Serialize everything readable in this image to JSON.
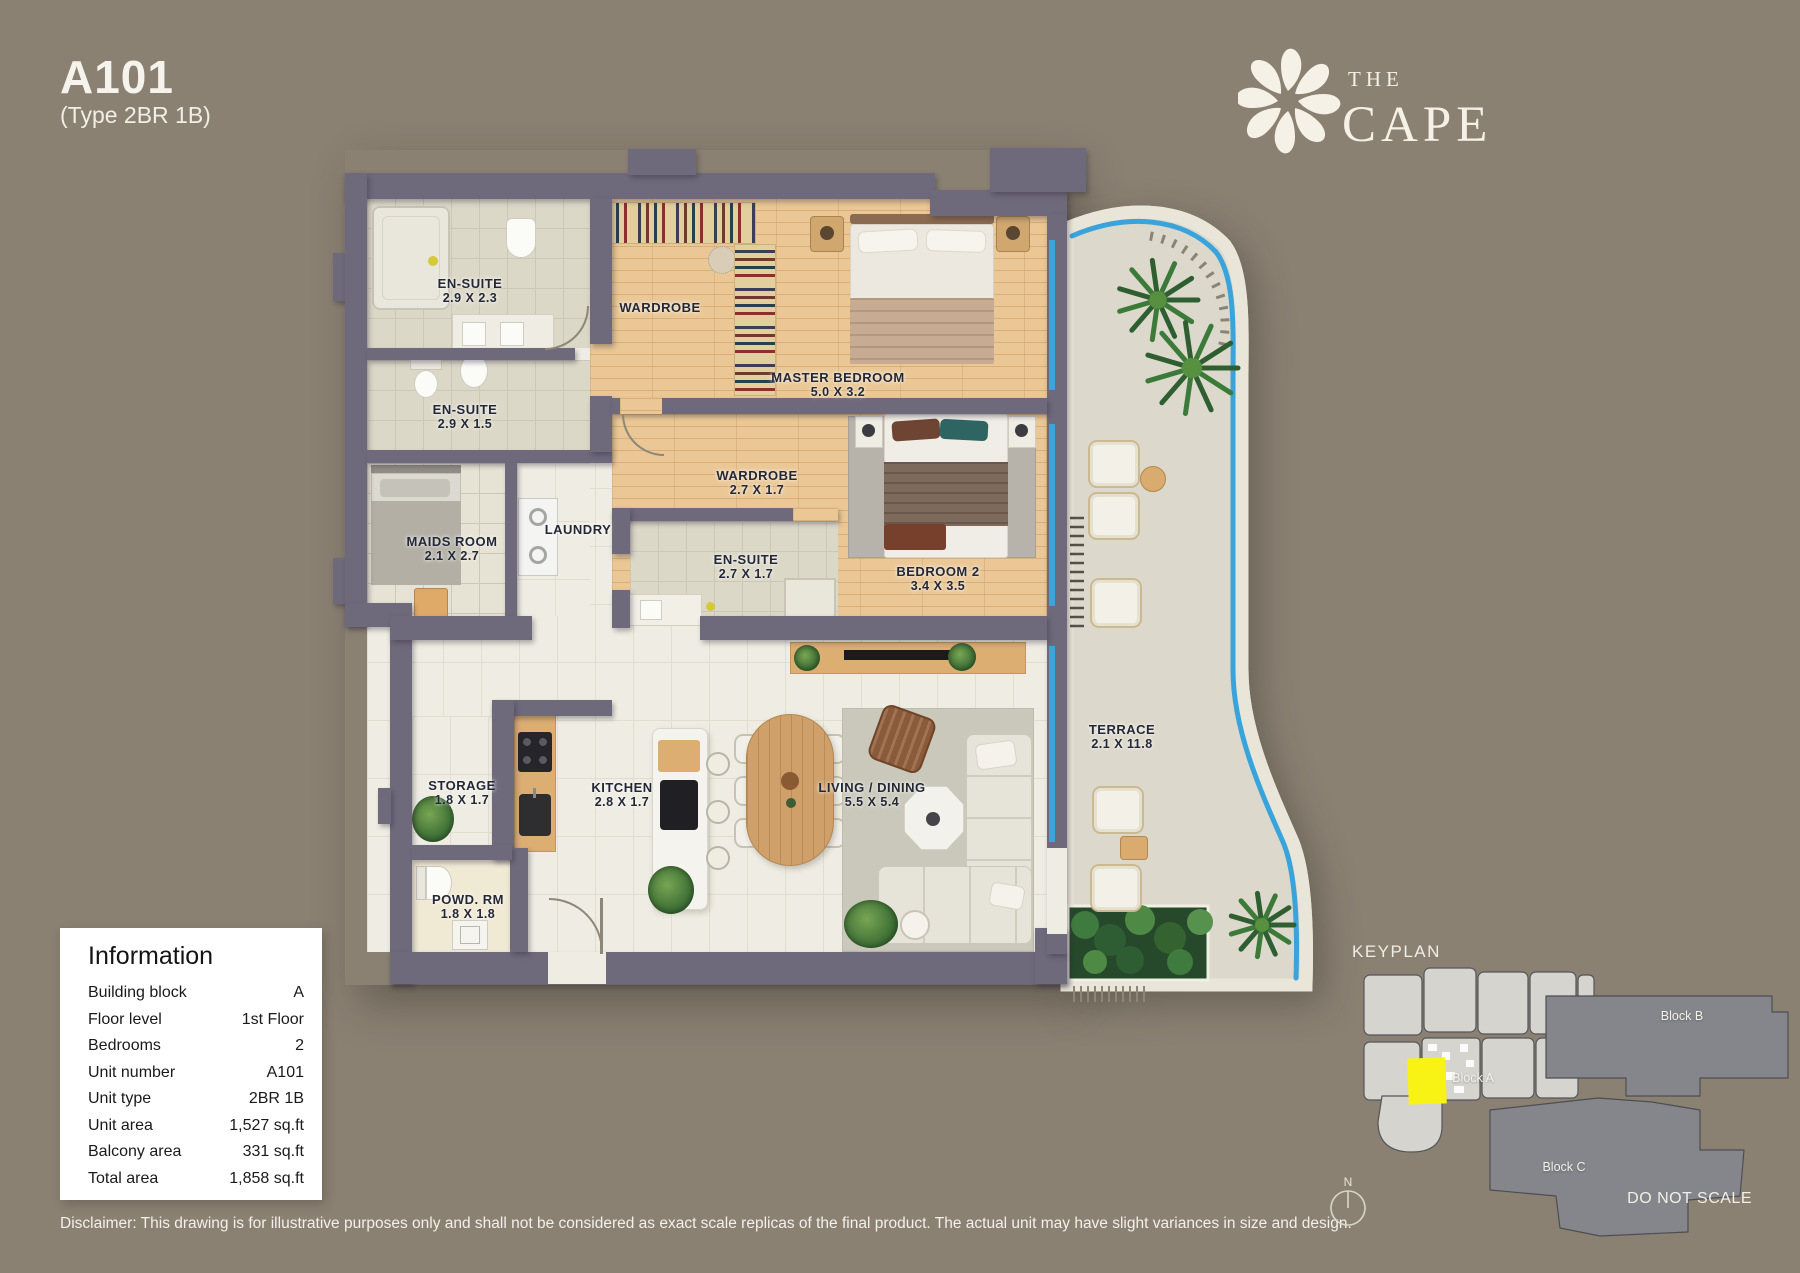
{
  "header": {
    "unit_code": "A101",
    "unit_type": "(Type 2BR 1B)"
  },
  "brand": {
    "word_top": "THE",
    "word_bottom": "CAPE",
    "logo_icon": "flower-icon"
  },
  "floorplan": {
    "rooms": [
      {
        "id": "ensuite-master",
        "label": "EN-SUITE",
        "dims": "2.9 X 2.3"
      },
      {
        "id": "ensuite-2",
        "label": "EN-SUITE",
        "dims": "2.9 X 1.5"
      },
      {
        "id": "maids-room",
        "label": "MAIDS ROOM",
        "dims": "2.1 X 2.7"
      },
      {
        "id": "laundry",
        "label": "LAUNDRY",
        "dims": ""
      },
      {
        "id": "wardrobe-master",
        "label": "WARDROBE",
        "dims": ""
      },
      {
        "id": "master-bedroom",
        "label": "MASTER BEDROOM",
        "dims": "5.0 X 3.2"
      },
      {
        "id": "wardrobe-2",
        "label": "WARDROBE",
        "dims": "2.7 X 1.7"
      },
      {
        "id": "ensuite-3",
        "label": "EN-SUITE",
        "dims": "2.7 X 1.7"
      },
      {
        "id": "bedroom-2",
        "label": "BEDROOM 2",
        "dims": "3.4 X 3.5"
      },
      {
        "id": "storage",
        "label": "STORAGE",
        "dims": "1.8 X 1.7"
      },
      {
        "id": "kitchen",
        "label": "KITCHEN",
        "dims": "2.8 X 1.7"
      },
      {
        "id": "living-dining",
        "label": "LIVING / DINING",
        "dims": "5.5 X 5.4"
      },
      {
        "id": "powder-room",
        "label": "POWD. RM",
        "dims": "1.8 X 1.8"
      },
      {
        "id": "terrace",
        "label": "TERRACE",
        "dims": "2.1 X 11.8"
      }
    ]
  },
  "info_panel": {
    "title": "Information",
    "rows": [
      {
        "label": "Building block",
        "value": "A"
      },
      {
        "label": "Floor level",
        "value": "1st Floor"
      },
      {
        "label": "Bedrooms",
        "value": "2"
      },
      {
        "label": "Unit number",
        "value": "A101"
      },
      {
        "label": "Unit type",
        "value": "2BR 1B"
      },
      {
        "label": "Unit area",
        "value": "1,527 sq.ft"
      },
      {
        "label": "Balcony area",
        "value": "331 sq.ft"
      },
      {
        "label": "Total area",
        "value": "1,858 sq.ft"
      }
    ]
  },
  "disclaimer": "Disclaimer: This drawing is for illustrative purposes only and shall not be considered as exact scale replicas of the final product. The actual unit may have slight variances in size and design.",
  "keyplan": {
    "title": "KEYPLAN",
    "blocks": [
      {
        "id": "block-a",
        "label": "Block A"
      },
      {
        "id": "block-b",
        "label": "Block B"
      },
      {
        "id": "block-c",
        "label": "Block C"
      }
    ],
    "north_label": "N",
    "do_not_scale": "DO NOT SCALE",
    "highlight_color": "#f8f315"
  },
  "colors": {
    "background": "#8a8173",
    "wall": "#6f6a7b",
    "window": "#3da4d9",
    "wood": "#eac795"
  }
}
